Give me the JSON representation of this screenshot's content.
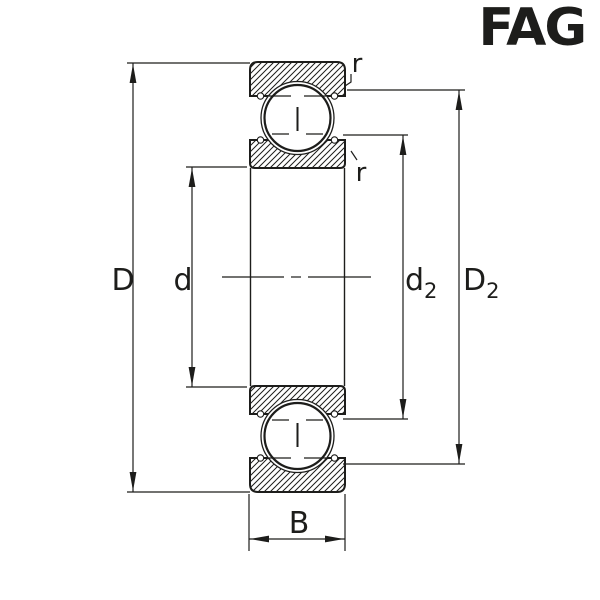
{
  "brand": {
    "logo_text": "FAG",
    "logo_color": "#e00b2c"
  },
  "drawing": {
    "background": "#ffffff",
    "line_color": "#1d1d1b",
    "labels": {
      "outer_diameter": "D",
      "bore_diameter": "d",
      "inner_shoulder_main": "d",
      "inner_shoulder_sub": "2",
      "outer_shoulder_main": "D",
      "outer_shoulder_sub": "2",
      "width": "B",
      "chamfer_outer": "r",
      "chamfer_inner": "r"
    }
  }
}
